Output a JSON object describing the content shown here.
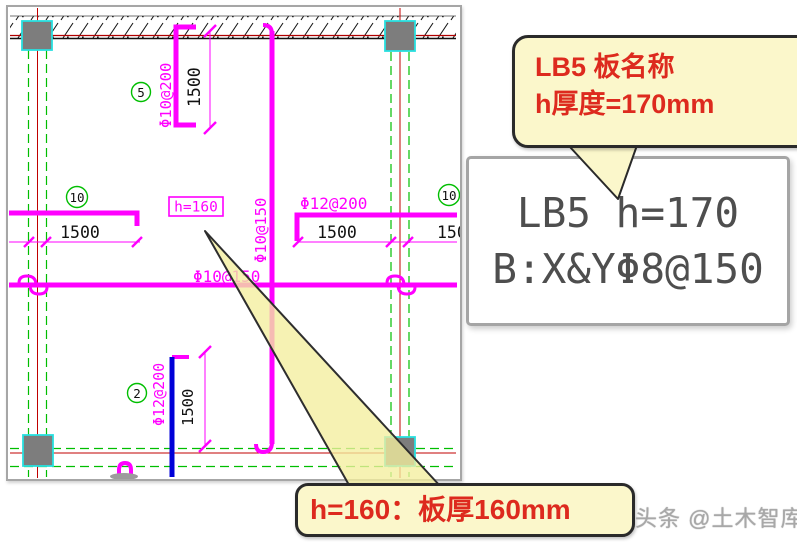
{
  "drawing": {
    "slab_tag": "h=160",
    "rebar_labels": {
      "top_vertical": "Φ10@200",
      "center_vertical": "Φ10@150",
      "center_horizontal": "Φ10@150",
      "right_horizontal": "Φ12@200",
      "bottom_vertical": "Φ12@200"
    },
    "dimensions": {
      "top": "1500",
      "left": "1500",
      "right": "1500",
      "right_edge": "1500",
      "bottom": "1500"
    },
    "axis_bubbles": {
      "top": "5",
      "left": "10",
      "right": "10",
      "bottom": "2"
    }
  },
  "cad_note_box": {
    "line1": "LB5 h=170",
    "line2": "B:X&YΦ8@150"
  },
  "callout_top": {
    "line1": "LB5 板名称",
    "line2": "h厚度=170mm"
  },
  "callout_bottom": {
    "text": "h=160：板厚160mm"
  },
  "watermark": {
    "text": "头条 @土木智库"
  },
  "colors": {
    "rebar": "#FF00FF",
    "grid_line": "#00BE00",
    "centerline": "#C00000",
    "extra_bar_blue": "#0000D8",
    "column_fill": "#7D7D7D",
    "column_edge": "#28E0E0",
    "callout_fill": "#FBF7CB",
    "callout_text": "#DD2A1E"
  }
}
